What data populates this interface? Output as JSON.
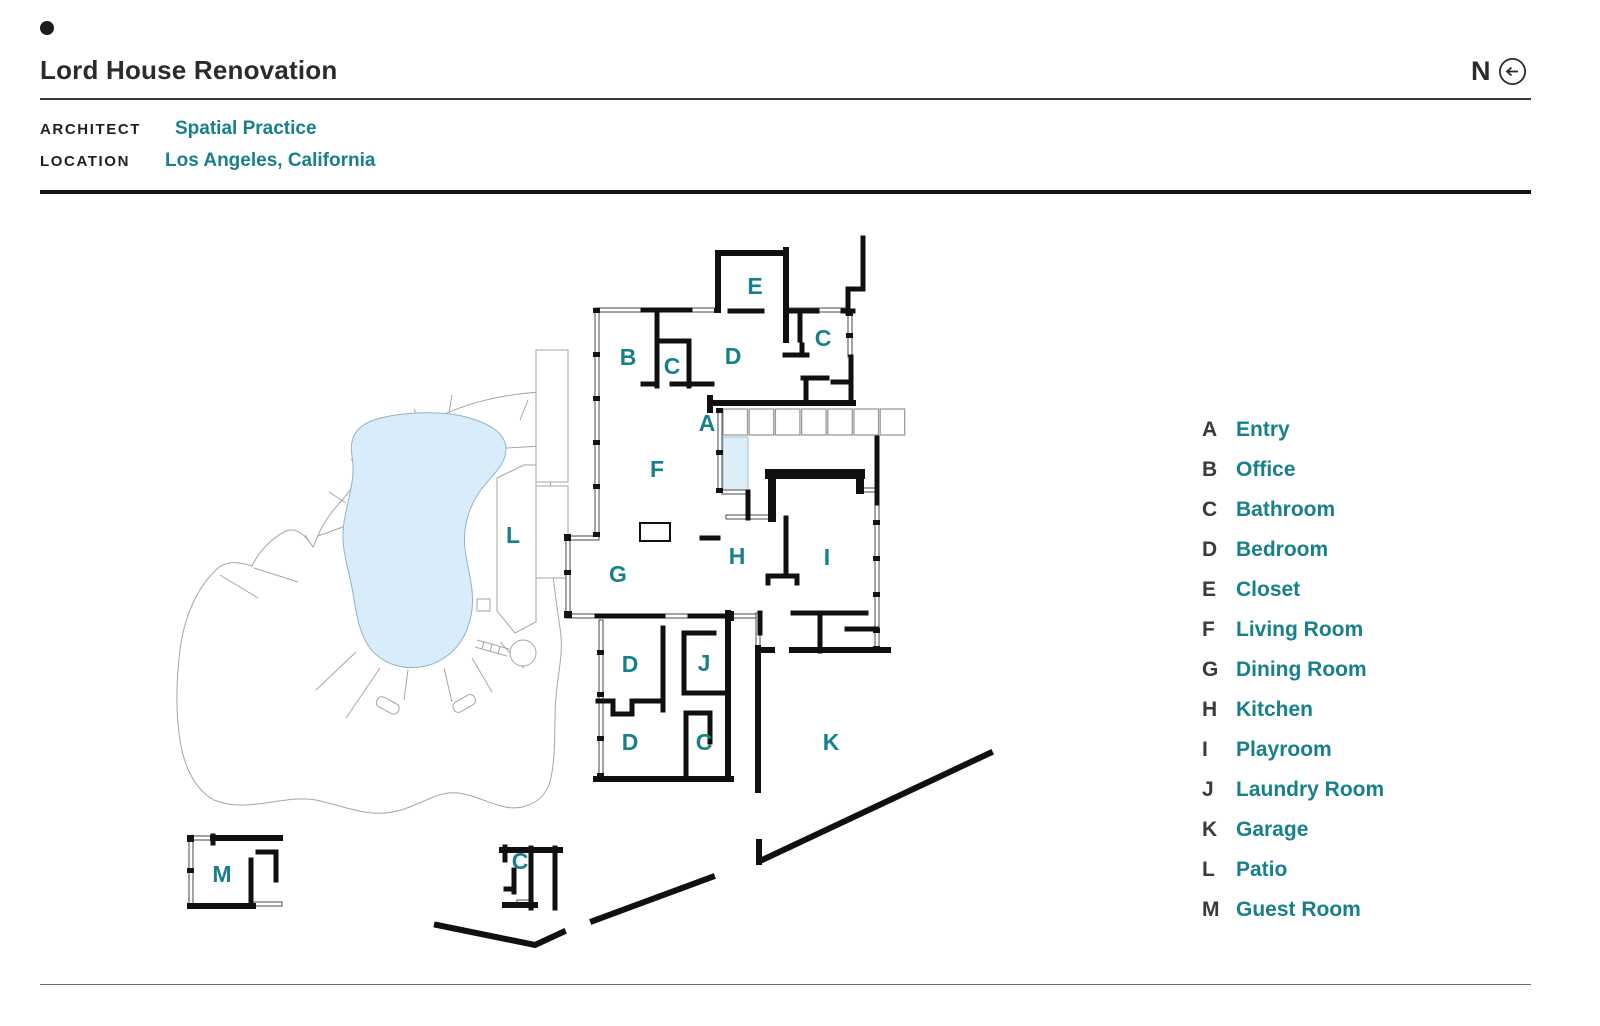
{
  "header": {
    "title": "Lord House Renovation",
    "north_label": "N"
  },
  "meta": {
    "architect_label": "ARCHITECT",
    "architect_value": "Spatial Practice",
    "location_label": "LOCATION",
    "location_value": "Los Angeles, California"
  },
  "legend": {
    "items": [
      {
        "key": "A",
        "name": "Entry"
      },
      {
        "key": "B",
        "name": "Office"
      },
      {
        "key": "C",
        "name": "Bathroom"
      },
      {
        "key": "D",
        "name": "Bedroom"
      },
      {
        "key": "E",
        "name": "Closet"
      },
      {
        "key": "F",
        "name": "Living Room"
      },
      {
        "key": "G",
        "name": "Dining Room"
      },
      {
        "key": "H",
        "name": "Kitchen"
      },
      {
        "key": "I",
        "name": "Playroom"
      },
      {
        "key": "J",
        "name": "Laundry Room"
      },
      {
        "key": "K",
        "name": "Garage"
      },
      {
        "key": "L",
        "name": "Patio"
      },
      {
        "key": "M",
        "name": "Guest Room"
      }
    ]
  },
  "plan": {
    "room_labels": [
      {
        "key": "A",
        "x": 707,
        "y": 423
      },
      {
        "key": "B",
        "x": 628,
        "y": 357
      },
      {
        "key": "C",
        "x": 672,
        "y": 366
      },
      {
        "key": "D",
        "x": 733,
        "y": 356
      },
      {
        "key": "E",
        "x": 755,
        "y": 286
      },
      {
        "key": "C",
        "x": 823,
        "y": 338
      },
      {
        "key": "F",
        "x": 657,
        "y": 469
      },
      {
        "key": "G",
        "x": 618,
        "y": 574
      },
      {
        "key": "H",
        "x": 737,
        "y": 556
      },
      {
        "key": "I",
        "x": 827,
        "y": 557
      },
      {
        "key": "L",
        "x": 513,
        "y": 535
      },
      {
        "key": "D",
        "x": 630,
        "y": 664
      },
      {
        "key": "J",
        "x": 704,
        "y": 663
      },
      {
        "key": "D",
        "x": 630,
        "y": 742
      },
      {
        "key": "C",
        "x": 704,
        "y": 742
      },
      {
        "key": "K",
        "x": 831,
        "y": 742
      },
      {
        "key": "M",
        "x": 222,
        "y": 874
      },
      {
        "key": "C",
        "x": 520,
        "y": 861
      }
    ]
  },
  "colors": {
    "accent_teal": "#17808A",
    "wall_black": "#101010",
    "pool_blue": "#D9ECF9",
    "site_gray": "#A6A6A6"
  }
}
